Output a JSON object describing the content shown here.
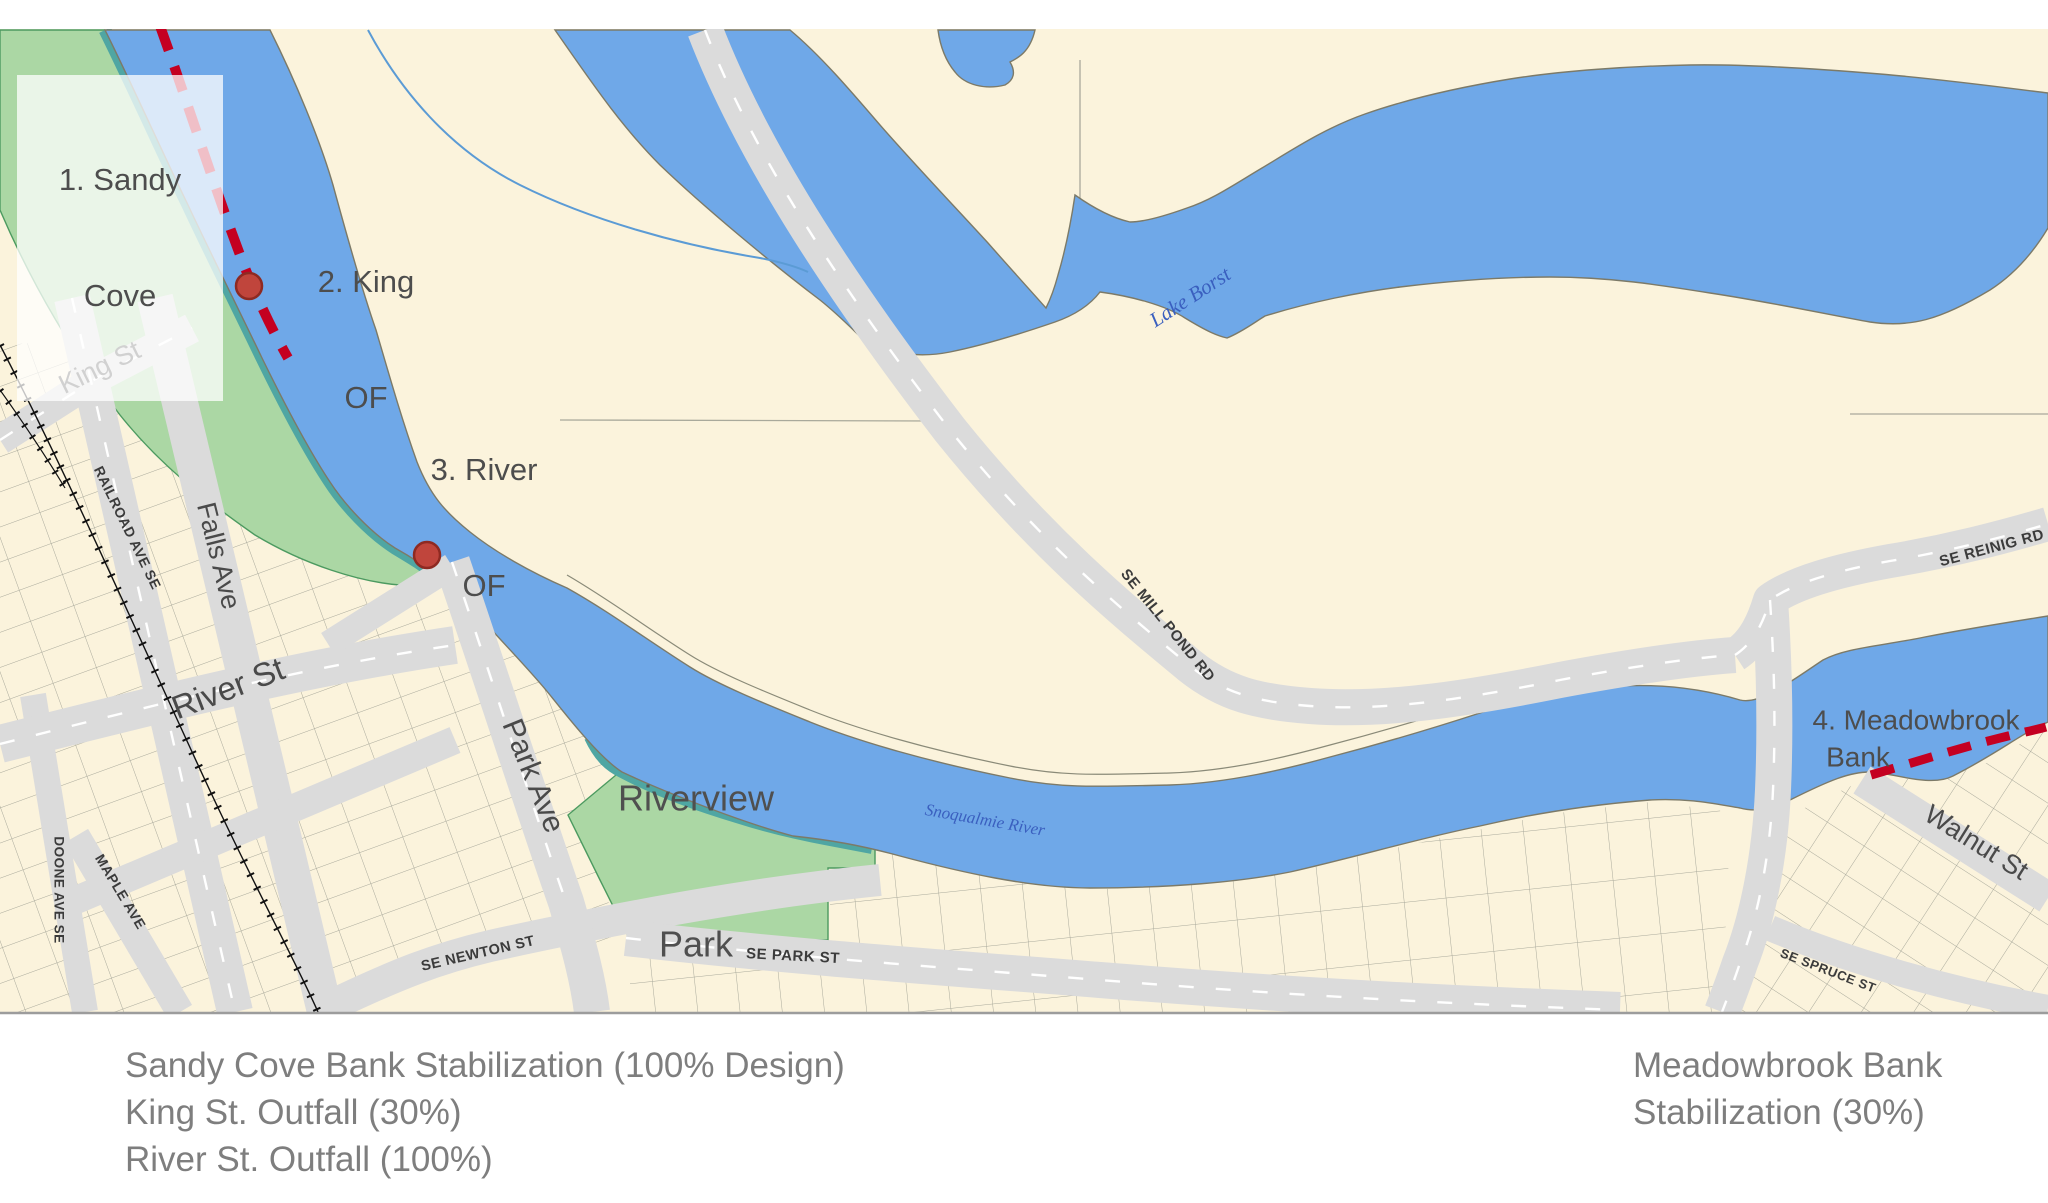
{
  "map": {
    "project_labels": {
      "sandy_cove": {
        "line1": "1. Sandy",
        "line2": "Cove"
      },
      "king_of": {
        "line1": "2. King",
        "line2": "OF"
      },
      "river_of": {
        "line1": "3. River",
        "line2": "OF"
      },
      "meadowbrook": {
        "line1": "4. Meadowbrook",
        "line2": "Bank"
      }
    },
    "park_labels": {
      "riverview": {
        "line1": "Riverview",
        "line2": "Park"
      }
    },
    "street_labels": {
      "king_st": "King St",
      "falls_ave": "Falls Ave",
      "railroad_ave": "RAILROAD AVE SE",
      "river_st": "River St",
      "park_ave": "Park Ave",
      "maple_ave": "MAPLE AVE",
      "doone_ave": "DOONE AVE SE",
      "se_newton": "SE NEWTON ST",
      "se_park": "SE PARK ST",
      "se_mill_pond": "SE MILL POND RD",
      "se_reinig": "SE REINIG RD",
      "walnut_st": "Walnut St",
      "se_spruce": "SE SPRUCE ST"
    },
    "water_labels": {
      "lake_borst": "Lake Borst",
      "snoqualmie_river": "Snoqualmie River"
    },
    "colors": {
      "water": "#6FA8E8",
      "park_green": "#ABD7A4",
      "bank_teal": "#4FA6A3",
      "road_gray": "#DBDBDB",
      "land_cream": "#FBF3DC",
      "project_red": "#C40021",
      "marker_red": "#C0453C"
    }
  },
  "captions": {
    "left": [
      "Sandy Cove Bank Stabilization (100% Design)",
      "King St. Outfall (30%)",
      "River St. Outfall (100%)"
    ],
    "right": [
      "Meadowbrook Bank",
      "Stabilization (30%)"
    ]
  }
}
